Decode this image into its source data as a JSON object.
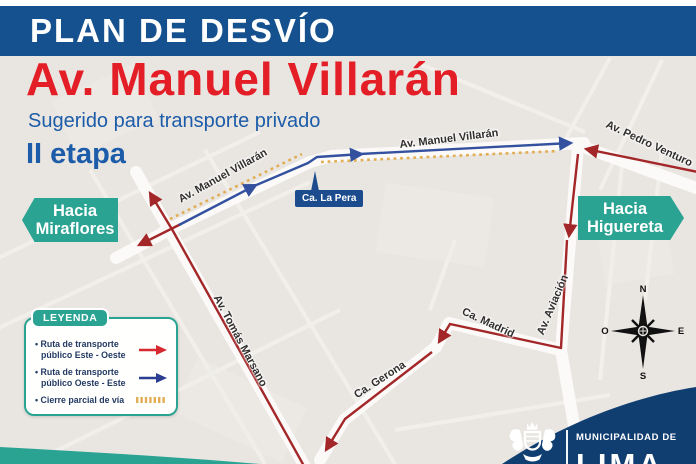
{
  "banner": {
    "title": "PLAN DE DESVÍO"
  },
  "heading": {
    "title": "Av. Manuel Villarán",
    "subtitle": "Sugerido para transporte privado",
    "stage": "II etapa"
  },
  "directions": {
    "west": {
      "line1": "Hacia",
      "line2": "Miraflores"
    },
    "east": {
      "line1": "Hacia",
      "line2": "Higuereta"
    }
  },
  "streets": {
    "villaran_left": "Av. Manuel Villarán",
    "villaran_right": "Av. Manuel Villarán",
    "pedro_venturo": "Av. Pedro Venturo",
    "la_pera": "Ca. La Pera",
    "tomas_marsano": "Av. Tomás Marsano",
    "aviacion": "Av. Aviación",
    "madrid": "Ca. Madrid",
    "gerona": "Ca. Gerona"
  },
  "legend": {
    "title": "LEYENDA",
    "items": [
      {
        "line1": "• Ruta de transporte",
        "line2": "público Este - Oeste",
        "marker": "east-west-red-arrow"
      },
      {
        "line1": "• Ruta de transporte",
        "line2": "público Oeste - Este",
        "marker": "west-east-blue-arrow"
      },
      {
        "line1": "• Cierre parcial de vía",
        "line2": "",
        "marker": "partial-closure-dashes"
      }
    ]
  },
  "compass": {
    "n": "N",
    "s": "S",
    "e": "E",
    "w": "O"
  },
  "footer": {
    "org_line1": "MUNICIPALIDAD DE",
    "org_line2": "LIMA"
  },
  "colors": {
    "banner_blue": "#15518e",
    "title_red": "#e31e26",
    "heading_blue": "#1c5ca8",
    "teal": "#2ba392",
    "route_red": "#a32629",
    "arrow_red": "#d7282f",
    "route_blue": "#33519f",
    "arrow_blue": "#2c3e92",
    "closure_yellow": "#e2ae55",
    "navy": "#113e71",
    "lapera_blue": "#1d4c8e",
    "label_ink": "#2f2e2c",
    "legend_ink": "#233a63",
    "map_bg": "#e9e6e2",
    "road_white": "#fbfaf8"
  }
}
